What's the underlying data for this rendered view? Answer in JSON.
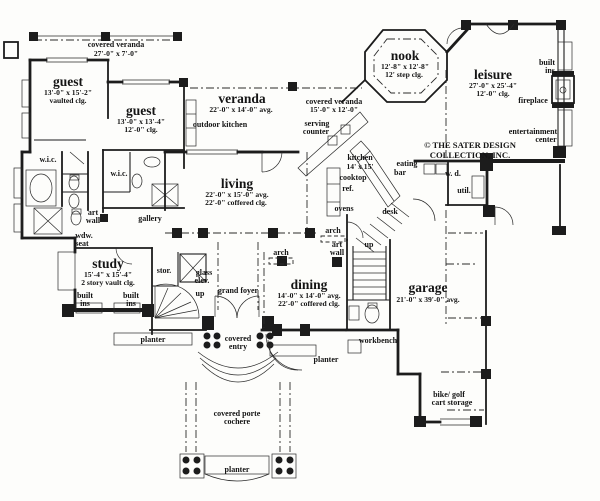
{
  "copyright": {
    "line1": "© THE SATER DESIGN",
    "line2": "COLLECTION, INC."
  },
  "rooms": {
    "guest1": {
      "title": "guest",
      "dim": "13'-0\" x 15'-2\"",
      "clg": "vaulted clg."
    },
    "guest2": {
      "title": "guest",
      "dim": "13'-0\" x 13'-4\"",
      "clg": "12'-0\" clg."
    },
    "veranda": {
      "title": "veranda",
      "dim": "22'-0\" x 14'-0\" avg."
    },
    "nook": {
      "title": "nook",
      "dim": "12'-8\" x 12'-8\"",
      "clg": "12' step clg."
    },
    "leisure": {
      "title": "leisure",
      "dim": "27'-0\" x 25'-4\"",
      "clg": "12'-0\" clg."
    },
    "living": {
      "title": "living",
      "dim": "22'-0\" x 15'-0\" avg.",
      "clg": "22'-0\" coffered clg."
    },
    "kitchen": {
      "title": "kitchen",
      "dim": "14' x 15'"
    },
    "study": {
      "title": "study",
      "dim": "15'-4\" x 15'-4\"",
      "clg": "2 story vault clg."
    },
    "dining": {
      "title": "dining",
      "dim": "14'-0\" x 14'-0\" avg.",
      "clg": "22'-0\" coffered clg."
    },
    "garage": {
      "title": "garage",
      "dim": "21'-0\" x 39'-0\" avg."
    }
  },
  "areas": {
    "covered_veranda_top": {
      "l1": "covered veranda",
      "l2": "27'-0\" x 7'-0\""
    },
    "covered_veranda_side": {
      "l1": "covered veranda",
      "l2": "15'-0\" x 12'-0\""
    },
    "outdoor_kitchen": "outdoor kitchen",
    "serving_counter": {
      "l1": "serving",
      "l2": "counter"
    },
    "eating_bar": {
      "l1": "eating",
      "l2": "bar"
    },
    "grand_foyer": "grand foyer",
    "gallery": "gallery",
    "covered_entry": {
      "l1": "covered",
      "l2": "entry"
    },
    "porte_cochere": {
      "l1": "covered porte",
      "l2": "cochere"
    },
    "bike_golf": {
      "l1": "bike/ golf",
      "l2": "cart storage"
    }
  },
  "features": {
    "wic1": "w.i.c.",
    "wic2": "w.i.c.",
    "built_ins_leisure": {
      "l1": "built",
      "l2": "ins."
    },
    "fireplace": "fireplace",
    "entertainment": {
      "l1": "entertainment",
      "l2": "center"
    },
    "cooktop": "cooktop",
    "ref": "ref.",
    "ovens": "ovens",
    "wd": "w. d.",
    "util": "util.",
    "desk": "desk",
    "art_wall_left": {
      "l1": "art",
      "l2": "wall"
    },
    "art_wall_right": {
      "l1": "art",
      "l2": "wall"
    },
    "wdw_seat": {
      "l1": "wdw.",
      "l2": "seat"
    },
    "arch_living": "arch",
    "arch_dining": "arch",
    "stor": "stor.",
    "glass_elev": {
      "l1": "glass",
      "l2": "elev."
    },
    "up_spiral": "up",
    "up_stair": "up",
    "built_ins_study_l": {
      "l1": "built",
      "l2": "ins"
    },
    "built_ins_study_r": {
      "l1": "built",
      "l2": "ins"
    },
    "planter_entry": "planter",
    "planter_side": "planter",
    "planter_front": "planter",
    "workbench": "workbench"
  }
}
